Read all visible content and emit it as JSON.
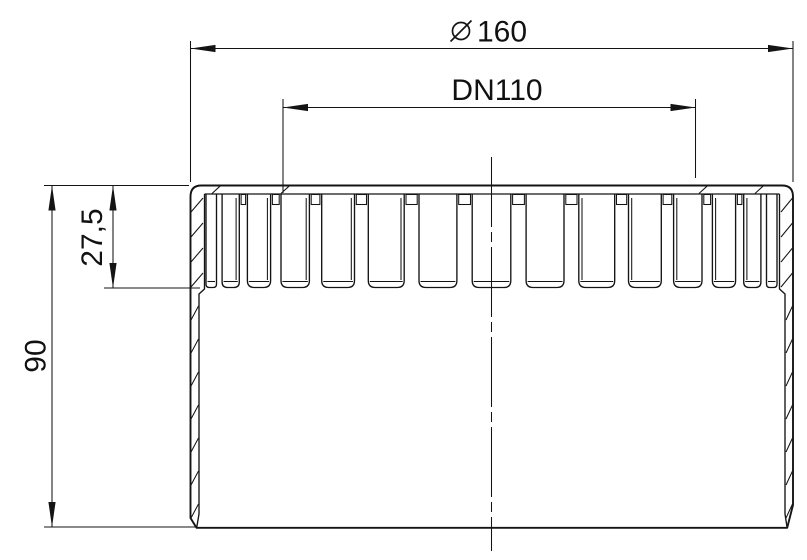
{
  "dimensions": {
    "diameter": {
      "symbol": "⌀",
      "value": "160"
    },
    "nominal_width": {
      "value": "DN110"
    },
    "slot_depth": {
      "value": "27,5"
    },
    "overall_height": {
      "value": "90"
    }
  },
  "colors": {
    "line": "#141414",
    "background": "#ffffff"
  }
}
